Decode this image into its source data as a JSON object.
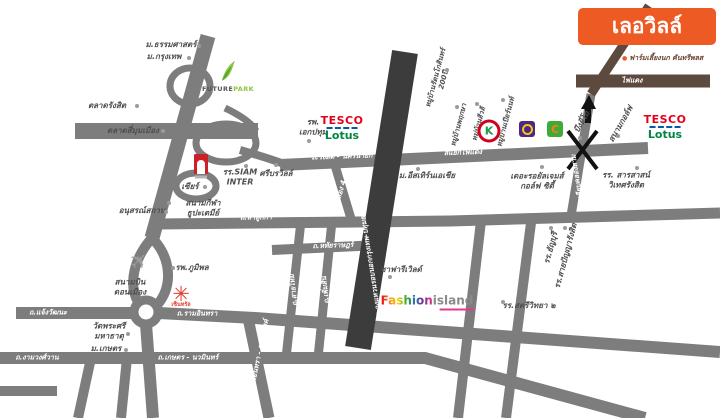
{
  "project": {
    "name": "เลอวิลล์",
    "bullet": "●",
    "subtitle": "ฟาร์มเลี้ยงนก คันทรีพลส"
  },
  "colors": {
    "accent_orange": "#ee5a24",
    "road_gray": "#7d7d7d",
    "ring_road_dark": "#3c3c3c",
    "route_brown": "#5c4a3f",
    "tesco_red": "#e4001b",
    "lotus_green": "#008542",
    "futurepark_green": "#8cc63e",
    "central_red": "#e03c31",
    "scb_purple": "#4f2683",
    "bigc_green": "#3faa35",
    "fashion_pink": "#e8368f"
  },
  "road_labels": {
    "rangsit": "ถ.รังสิต - นครนายก",
    "red_light": "สี่แยกไฟแดง",
    "fai_daeng": "ไฟแดง",
    "khlong4": "คลอง 4",
    "lamlukka": "ถ.ลำลูกกา",
    "liap_khlong3": "ถ.เลียบคลองสาม",
    "sai_mai": "ถ.สายไหม",
    "phoem_sin": "ถ.เพิ่มสิน",
    "hathairat": "ถ.หทัยราษฎร์",
    "outer_ring": "ถ.วงแหวนรอบนอกกรุงเทพ-ปทุมธานี",
    "chaengwattana": "ถ.แจ้งวัฒนะ",
    "ramindra": "ถ.รามอินทรา",
    "ngamwongwan": "ถ.งามวงศ์วาน",
    "kaset_nawamin": "ถ.เกษตร - นวมินทร์",
    "expressway": "ทางด่วนรามอินทรา - อาจณรงค์"
  },
  "landmarks": {
    "thammasat": "ม.ธรรมศาสตร์",
    "bangkok_u": "ม.กรุงเทพ",
    "talad_rangsit": "ตลาดรังสิต",
    "talad_simummuang": "ตลาดสี่มุมเมือง",
    "zeer": "เซียร์",
    "stadium1": "สนามกีฬา",
    "stadium2": "ธูปะเตมีย์",
    "memorial": "อนุสรณ์สถาน",
    "airport1": "สนามบิน",
    "airport2": "ดอนเมือง",
    "bhumibol": "รพ.ภูมิพล",
    "watphrasri1": "วัดพระศรี",
    "watphrasri2": "มหาธาตุ",
    "kaset_u": "ม.เกษตร",
    "ekpathum1": "รพ.",
    "ekpathum2": "เอกปทุม",
    "siam_inter1": "รร.SIAM",
    "siam_inter2": "INTER",
    "sri_bora": "ศรีบรวิลล์",
    "eastern_asia": "ม.อีสเทิร์นเอเชีย",
    "royal_gems1": "เดอะรอยัลเจมส์",
    "royal_gems2": "กอล์ฟ ซิตี้",
    "safari": "ซาฟารีเวิลด์",
    "satri_wit": "รร.สตรีวิทยา ๒",
    "sarasas1": "รร. สารสาสน์",
    "sarasas2": "วิเทศรังสิต",
    "thanyaburi": "รร.ธัญบุรี",
    "saipanya": "รร.สายปัญญารังสิต",
    "bueng_yitho": "บึงยี่โถ",
    "golf": "สนามกอล์ฟ"
  },
  "villages": {
    "v1a": "หมู่บ้านรัตนโกสินทร์",
    "v1b": "200ปี",
    "v2": "หมู่บ้านพฤกษา",
    "v3": "หมู่บ้านสีวลี",
    "v4": "หมู่บ้านเปียร์นนท์"
  },
  "logos": {
    "future_park": {
      "future": "FUTURE",
      "park": "PARK"
    },
    "tesco_lotus": {
      "tesco": "TESCO",
      "lotus": "Lotus"
    },
    "fashion_island": {
      "fashion": "Fashion",
      "island": "island"
    },
    "central": {
      "caption": "เซ็นทรัล"
    },
    "big_c": {
      "letter": "C"
    },
    "kbank": {
      "letter": "K"
    }
  },
  "icons": {
    "airplane": "✈",
    "central_star": "✳"
  }
}
